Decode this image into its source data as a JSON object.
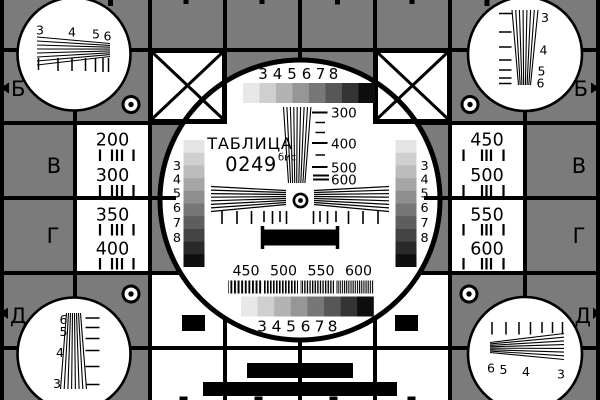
{
  "colors": {
    "background": "#7b7b7b",
    "ink": "#000000",
    "panel": "#ffffff"
  },
  "title": {
    "name": "ТАБЛИЦА",
    "number": "0249",
    "suffix": "бис"
  },
  "edge_letters": {
    "top_left": "Б",
    "top_right": "Б",
    "mid_left_upper": "В",
    "mid_right_upper": "В",
    "mid_left_lower": "Г",
    "mid_right_lower": "Г",
    "bottom_left": "Д",
    "bottom_right": "Д"
  },
  "left_panel_values": [
    "200",
    "300",
    "350",
    "400"
  ],
  "right_panel_values": [
    "450",
    "500",
    "550",
    "600"
  ],
  "center_circle": {
    "top_row_digits": [
      "3",
      "4",
      "5",
      "6",
      "7",
      "8"
    ],
    "bottom_row_digits": [
      "3",
      "4",
      "5",
      "6",
      "7",
      "8"
    ],
    "left_scale_digits": [
      "3",
      "4",
      "5",
      "6",
      "7",
      "8"
    ],
    "right_scale_digits": [
      "3",
      "4",
      "5",
      "6",
      "7",
      "8"
    ],
    "resolution_labels": [
      "300",
      "400",
      "500",
      "600"
    ],
    "frequency_labels": [
      "450",
      "500",
      "550",
      "600"
    ]
  },
  "corner_wedge_labels": {
    "top_left": [
      "3",
      "4",
      "5",
      "6"
    ],
    "top_right": [
      "3",
      "4",
      "5",
      "6"
    ],
    "bottom_left": [
      "6",
      "5",
      "4",
      "3"
    ],
    "bottom_right": [
      "6",
      "5",
      "4",
      "3"
    ]
  },
  "grayscale_8": [
    "#e8e8e8",
    "#cfcfcf",
    "#b3b3b3",
    "#969696",
    "#777777",
    "#575757",
    "#343434",
    "#0d0d0d"
  ],
  "grayscale_10": [
    "#e4e4e4",
    "#d0d0d0",
    "#bcbcbc",
    "#a6a6a6",
    "#8f8f8f",
    "#777777",
    "#5e5e5e",
    "#444444",
    "#2a2a2a",
    "#0e0e0e"
  ]
}
